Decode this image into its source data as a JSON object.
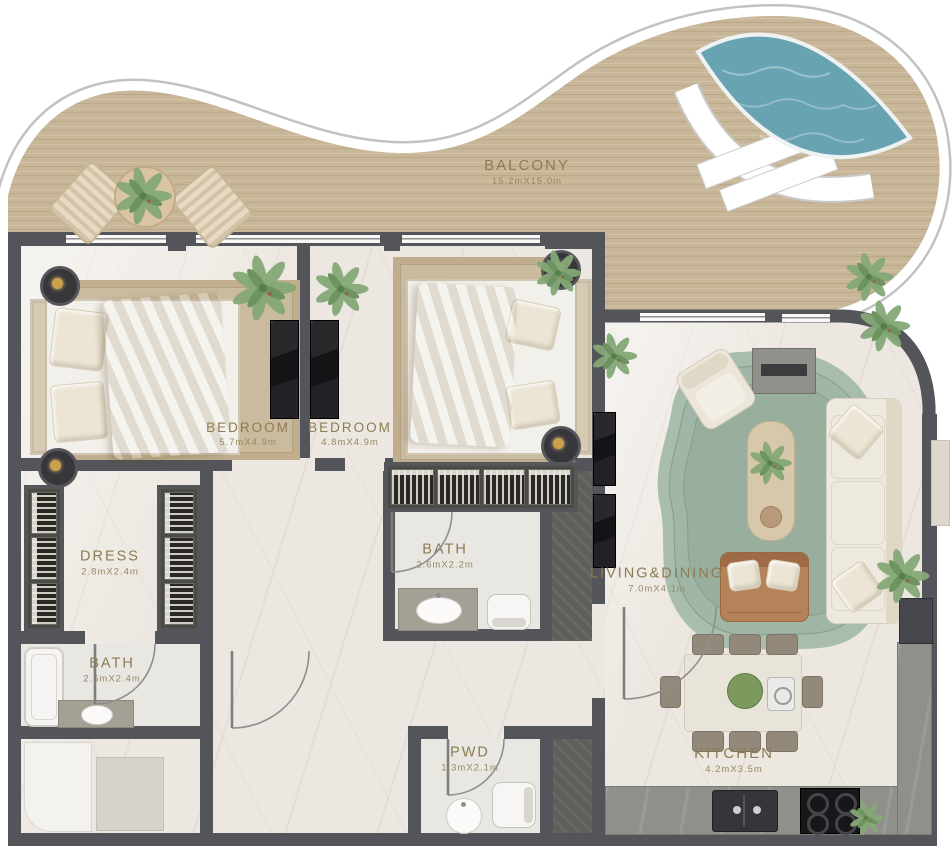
{
  "floor_plan": {
    "type": "apartment-floor-plan",
    "rooms": [
      {
        "id": "balcony",
        "name": "BALCONY",
        "dims": "15.2mX15.0m"
      },
      {
        "id": "bedroom-1",
        "name": "BEDROOM",
        "dims": "5.7mX4.9m"
      },
      {
        "id": "bedroom-2",
        "name": "BEDROOM",
        "dims": "4.8mX4.9m"
      },
      {
        "id": "dress",
        "name": "DRESS",
        "dims": "2.8mX2.4m"
      },
      {
        "id": "bath-2",
        "name": "BATH",
        "dims": "2.6mX2.2m"
      },
      {
        "id": "bath-1",
        "name": "BATH",
        "dims": "2.5mX2.4m"
      },
      {
        "id": "pwd",
        "name": "PWD",
        "dims": "1.3mX2.1m"
      },
      {
        "id": "living-dining",
        "name": "LIVING&DINING",
        "dims": "7.0mX4.1m"
      },
      {
        "id": "kitchen",
        "name": "KITCHEN",
        "dims": "4.2mX3.5m"
      }
    ],
    "colors": {
      "wall": "#54555a",
      "balcony_wood": "#c8b699",
      "interior_marble": "#ece7e0",
      "pool_water": "#68a3b1",
      "rug_green": "#a9bdae",
      "bedroom_rug": "#cbbb9e",
      "label_text": "#8d7b52",
      "black_marble": "#1c1b1e",
      "rim_white": "#ffffff"
    },
    "features": [
      "pool",
      "wrap-around balcony",
      "open kitchen",
      "walk-in dress room"
    ]
  }
}
